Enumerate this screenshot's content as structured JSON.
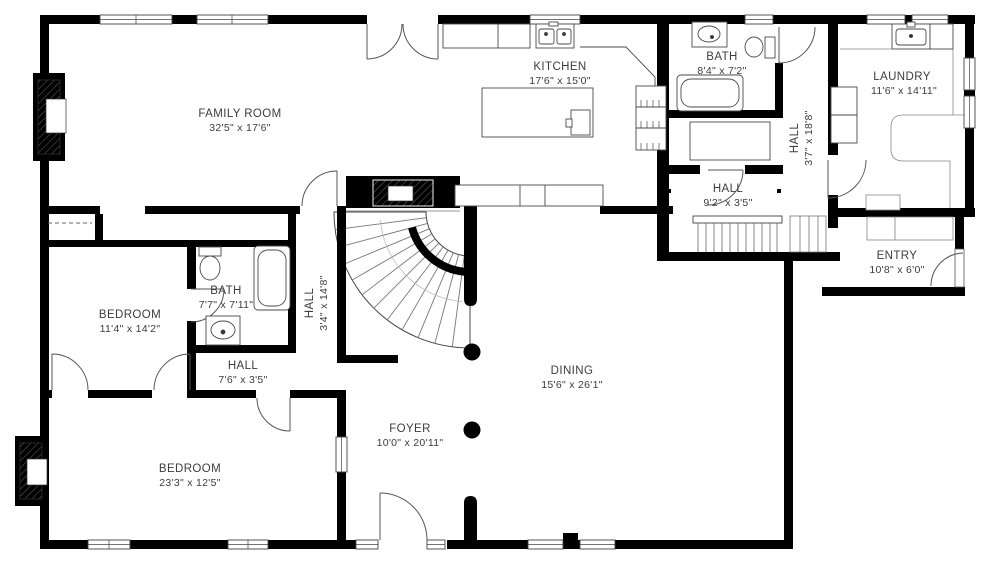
{
  "page": {
    "type": "floor-plan",
    "background": "#ffffff"
  },
  "colors": {
    "wall": "#000000",
    "label": "#3c3c3c",
    "fixture_line": "#4a4a4a"
  },
  "rooms": [
    {
      "name": "FAMILY ROOM",
      "dims": "32'5\" x 17'6\""
    },
    {
      "name": "KITCHEN",
      "dims": "17'6\" x 15'0\""
    },
    {
      "name": "BATH",
      "dims": "8'4\" x 7'2\""
    },
    {
      "name": "LAUNDRY",
      "dims": "11'6\" x 14'11\""
    },
    {
      "name": "HALL",
      "dims": "3'7\" x 18'8\""
    },
    {
      "name": "HALL",
      "dims": "9'2\" x 3'5\""
    },
    {
      "name": "ENTRY",
      "dims": "10'8\" x 6'0\""
    },
    {
      "name": "BEDROOM",
      "dims": "11'4\" x 14'2\""
    },
    {
      "name": "BATH",
      "dims": "7'7\" x 7'11\""
    },
    {
      "name": "HALL",
      "dims": "7'6\" x 3'5\""
    },
    {
      "name": "HALL",
      "dims": "3'4\" x 14'8\""
    },
    {
      "name": "BEDROOM",
      "dims": "23'3\" x 12'5\""
    },
    {
      "name": "FOYER",
      "dims": "10'0\" x 20'11\""
    },
    {
      "name": "DINING",
      "dims": "15'6\" x 26'1\""
    }
  ]
}
